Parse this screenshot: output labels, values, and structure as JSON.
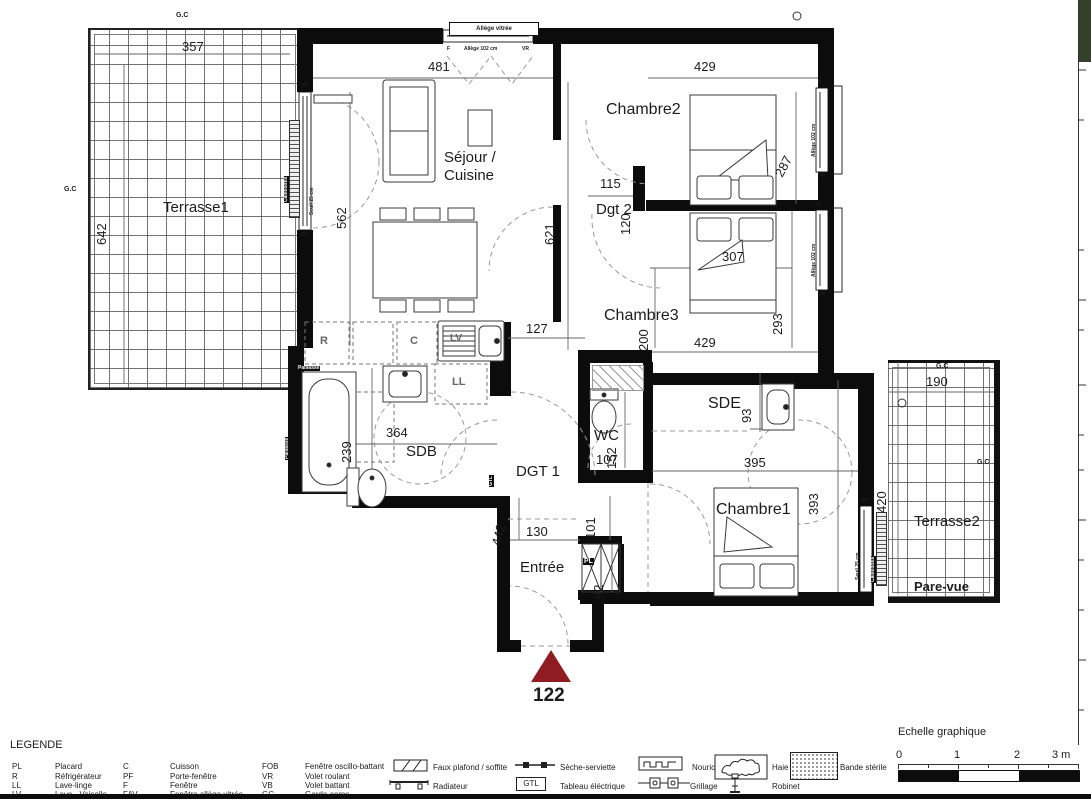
{
  "rooms": {
    "terrasse1": "Terrasse1",
    "sejour_l1": "Séjour /",
    "sejour_l2": "Cuisine",
    "chambre2": "Chambre2",
    "dgt2": "Dgt 2",
    "chambre3": "Chambre3",
    "sdb": "SDB",
    "wc": "WC",
    "dgt1": "DGT 1",
    "sde": "SDE",
    "chambre1": "Chambre1",
    "terrasse2": "Terrasse2",
    "entree": "Entrée",
    "pare_vue": "Pare-vue"
  },
  "dims": {
    "d357": "357",
    "d642": "642",
    "d481": "481",
    "d562": "562",
    "d621": "621",
    "d429a": "429",
    "d287": "287",
    "d115": "115",
    "d120": "120",
    "d307": "307",
    "d200": "200",
    "d293": "293",
    "d429b": "429",
    "d127": "127",
    "d239": "239",
    "d364": "364",
    "d152": "152",
    "d107": "107",
    "d93": "93",
    "d395": "395",
    "d101": "101",
    "d442": "442",
    "d130": "130",
    "d92": "92",
    "d393": "393",
    "d190": "190",
    "d420": "420"
  },
  "ann": {
    "gc": "G.C",
    "f": "F",
    "vr": "VR",
    "pf": "PF",
    "allege_vitree": "Allège vitrée",
    "allege102": "Allège 102 cm",
    "seuil25": "Seuil 25 cm",
    "caillebotis": "Caillebotis",
    "paillasse": "Paillasse",
    "r": "R",
    "c": "C",
    "lv": "LV",
    "ll": "LL",
    "gtl": "GTL",
    "pl": "PL"
  },
  "unit": {
    "number": "122"
  },
  "legend": {
    "title": "LEGENDE",
    "col1": [
      {
        "abbr": "PL",
        "name": "Placard"
      },
      {
        "abbr": "R",
        "name": "Réfrigérateur"
      },
      {
        "abbr": "LL",
        "name": "Lave-linge"
      },
      {
        "abbr": "LV",
        "name": "Lave - Vaiselle"
      }
    ],
    "col2": [
      {
        "abbr": "C",
        "name": "Cuisson"
      },
      {
        "abbr": "PF",
        "name": "Porte-fenêtre"
      },
      {
        "abbr": "F",
        "name": "Fenêtre"
      },
      {
        "abbr": "FAV",
        "name": "Fenêtre allège vitrée"
      }
    ],
    "col3": [
      {
        "abbr": "FOB",
        "name": "Fenêtre oscillo-battant"
      },
      {
        "abbr": "VR",
        "name": "Volet roulant"
      },
      {
        "abbr": "VB",
        "name": "Volet battant"
      },
      {
        "abbr": "GC",
        "name": "Garde-corps"
      }
    ],
    "symbols": {
      "faux_plafond": "Faux plafond / soffite",
      "radiateur": "Radiateur",
      "seche_serviette": "Sèche-serviette",
      "tableau": "Tableau éléctrique",
      "nourice": "Nourice",
      "grillage": "Grillage",
      "haie": "Haie",
      "robinet": "Robinet",
      "bande_sterile": "Bande stérile"
    },
    "scale": {
      "title": "Echelle graphique",
      "t0": "0",
      "t1": "1",
      "t2": "2",
      "t3": "3 m"
    }
  },
  "colors": {
    "arrow": "#8e1c21",
    "wall": "#0c0c0c"
  }
}
